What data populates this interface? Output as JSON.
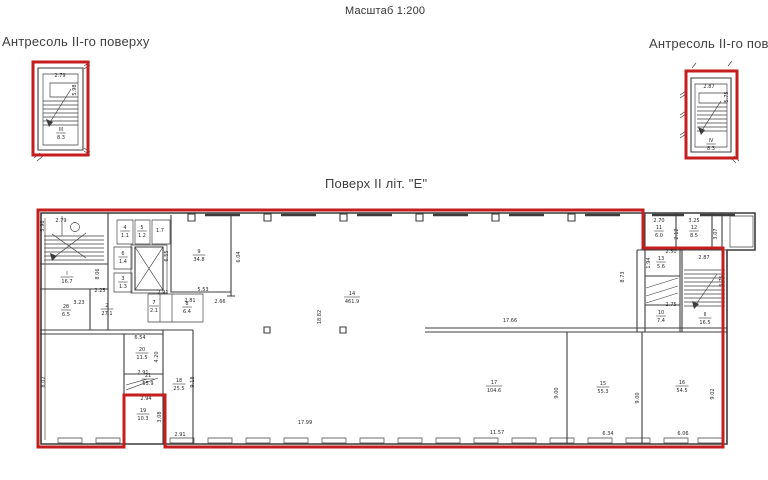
{
  "colors": {
    "red": "#c41e1e",
    "line": "#3c3c3c",
    "text": "#2a2a2a",
    "dim_blue": "#3a4fae"
  },
  "header": {
    "scale_note": "Масштаб 1:200"
  },
  "left_mezzanine": {
    "title": "Антресоль II-го поверху"
  },
  "right_mezzanine": {
    "title": "Антресоль II-го поверху"
  },
  "main_plan": {
    "title": "Поверх II літ. \"Е\""
  },
  "annotations": {
    "room_labels": [
      {
        "n": "III",
        "a": "8.3",
        "x": 61,
        "y": 133
      },
      {
        "n": "IV",
        "a": "8.3",
        "x": 711,
        "y": 144
      },
      {
        "n": "I",
        "a": "16.7",
        "x": 67,
        "y": 277
      },
      {
        "n": "2б",
        "a": "6.5",
        "x": 66,
        "y": 310
      },
      {
        "n": "2",
        "a": "27.1",
        "x": 107,
        "y": 309
      },
      {
        "n": "4",
        "a": "1.1",
        "x": 125,
        "y": 231
      },
      {
        "n": "5",
        "a": "1.2",
        "x": 142,
        "y": 231
      },
      {
        "n": "6",
        "a": "1.4",
        "x": 123,
        "y": 257
      },
      {
        "n": "3",
        "a": "1.3",
        "x": 123,
        "y": 282
      },
      {
        "n": "9",
        "a": "34.8",
        "x": 199,
        "y": 255
      },
      {
        "n": "7",
        "a": "2.1",
        "x": 154,
        "y": 306
      },
      {
        "n": "8",
        "a": "6.4",
        "x": 187,
        "y": 307
      },
      {
        "n": "14",
        "a": "461.9",
        "x": 352,
        "y": 297
      },
      {
        "n": "11",
        "a": "6.0",
        "x": 659,
        "y": 231
      },
      {
        "n": "12",
        "a": "8.5",
        "x": 694,
        "y": 231
      },
      {
        "n": "13",
        "a": "5.6",
        "x": 661,
        "y": 262
      },
      {
        "n": "10",
        "a": "7.4",
        "x": 661,
        "y": 316
      },
      {
        "n": "II",
        "a": "16.5",
        "x": 705,
        "y": 318
      },
      {
        "n": "17",
        "a": "104.6",
        "x": 494,
        "y": 386
      },
      {
        "n": "15",
        "a": "55.3",
        "x": 603,
        "y": 387
      },
      {
        "n": "16",
        "a": "54.5",
        "x": 682,
        "y": 386
      },
      {
        "n": "18",
        "a": "25.5",
        "x": 179,
        "y": 384
      },
      {
        "n": "19",
        "a": "10.3",
        "x": 143,
        "y": 414
      },
      {
        "n": "20",
        "a": "11.5",
        "x": 142,
        "y": 353
      },
      {
        "n": "21",
        "a": "55.9",
        "x": 148,
        "y": 379
      }
    ],
    "dims": [
      {
        "t": "2.79",
        "x": 60,
        "y": 77
      },
      {
        "t": "5.98",
        "x": 76,
        "y": 90,
        "r": 1
      },
      {
        "t": "2.87",
        "x": 709,
        "y": 88
      },
      {
        "t": "5.75",
        "x": 728,
        "y": 97,
        "r": 1
      },
      {
        "t": "2.79",
        "x": 61,
        "y": 222
      },
      {
        "t": "5.98",
        "x": 44,
        "y": 226,
        "r": 1
      },
      {
        "t": "8.06",
        "x": 99,
        "y": 274,
        "r": 1
      },
      {
        "t": "2.25",
        "x": 100,
        "y": 292
      },
      {
        "t": "3.23",
        "x": 79,
        "y": 304
      },
      {
        "t": "6.55",
        "x": 168,
        "y": 256,
        "r": 1
      },
      {
        "t": "1.7",
        "x": 160,
        "y": 232
      },
      {
        "t": "5.53",
        "x": 203,
        "y": 291
      },
      {
        "t": "2.81",
        "x": 190,
        "y": 302
      },
      {
        "t": "2.66",
        "x": 220,
        "y": 303
      },
      {
        "t": "2.91",
        "x": 163,
        "y": 294
      },
      {
        "t": "6.04",
        "x": 240,
        "y": 257,
        "r": 1
      },
      {
        "t": "18.82",
        "x": 321,
        "y": 317,
        "r": 1
      },
      {
        "t": "17.66",
        "x": 510,
        "y": 322
      },
      {
        "t": "17.99",
        "x": 305,
        "y": 424
      },
      {
        "t": "2.94",
        "x": 146,
        "y": 400
      },
      {
        "t": "2.91",
        "x": 143,
        "y": 374
      },
      {
        "t": "4.20",
        "x": 158,
        "y": 357,
        "r": 1
      },
      {
        "t": "9.18",
        "x": 194,
        "y": 382,
        "r": 1
      },
      {
        "t": "8.02",
        "x": 45,
        "y": 382,
        "r": 1
      },
      {
        "t": "6.54",
        "x": 140,
        "y": 339
      },
      {
        "t": "3.08",
        "x": 161,
        "y": 417,
        "r": 1
      },
      {
        "t": "2.91",
        "x": 180,
        "y": 436
      },
      {
        "t": "11.57",
        "x": 497,
        "y": 434
      },
      {
        "t": "6.34",
        "x": 608,
        "y": 435
      },
      {
        "t": "6.06",
        "x": 683,
        "y": 435,
        "c": "#3a4fae"
      },
      {
        "t": "9.00",
        "x": 558,
        "y": 393,
        "r": 1
      },
      {
        "t": "9.00",
        "x": 639,
        "y": 398,
        "r": 1
      },
      {
        "t": "9.02",
        "x": 714,
        "y": 394,
        "r": 1
      },
      {
        "t": "8.73",
        "x": 624,
        "y": 277,
        "r": 1
      },
      {
        "t": "2.70",
        "x": 659,
        "y": 222
      },
      {
        "t": "3.25",
        "x": 694,
        "y": 222
      },
      {
        "t": "2.12",
        "x": 678,
        "y": 234,
        "r": 1
      },
      {
        "t": "3.07",
        "x": 717,
        "y": 234,
        "r": 1
      },
      {
        "t": "2.50",
        "x": 671,
        "y": 253
      },
      {
        "t": "1.94",
        "x": 650,
        "y": 263,
        "r": 1
      },
      {
        "t": "2.87",
        "x": 704,
        "y": 259
      },
      {
        "t": "5.75",
        "x": 723,
        "y": 281,
        "r": 1
      },
      {
        "t": "2.75",
        "x": 671,
        "y": 306
      }
    ]
  }
}
